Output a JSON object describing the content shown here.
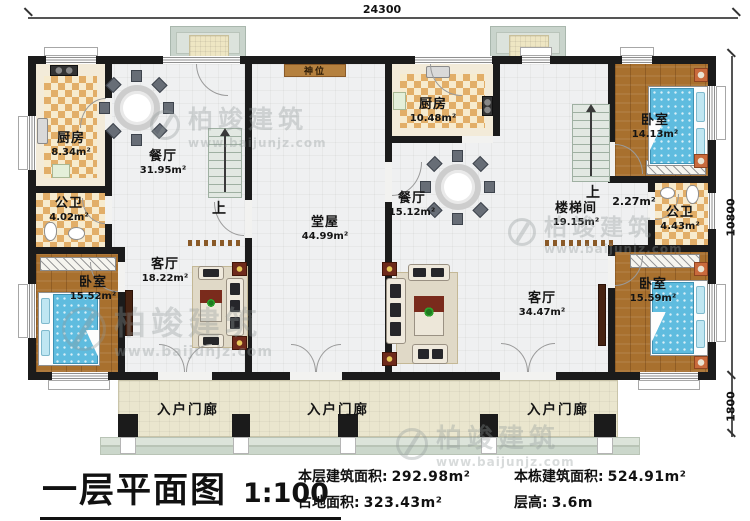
{
  "plan": {
    "dim_top": "24300",
    "dim_right": "10800",
    "dim_porch": "1800",
    "up_label": "上",
    "shrine_label": "神位",
    "porch_label": "入户门廊",
    "rooms": {
      "kitchen_left": {
        "name": "厨房",
        "area": "8.34m²"
      },
      "bath_left": {
        "name": "公卫",
        "area": "4.02m²"
      },
      "bedroom_left": {
        "name": "卧室",
        "area": "15.52m²"
      },
      "dining_left": {
        "name": "餐厅",
        "area": "31.95m²"
      },
      "living_left": {
        "name": "客厅",
        "area": "18.22m²"
      },
      "hall": {
        "name": "堂屋",
        "area": "44.99m²"
      },
      "kitchen_right": {
        "name": "厨房",
        "area": "10.48m²"
      },
      "dining_right": {
        "name": "餐厅",
        "area": "15.12m²"
      },
      "stairwell": {
        "name": "楼梯间",
        "area": "19.15m²"
      },
      "corridor": {
        "area": "2.27m²"
      },
      "bedroom_top_right": {
        "name": "卧室",
        "area": "14.13m²"
      },
      "bath_right": {
        "name": "公卫",
        "area": "4.43m²"
      },
      "bedroom_bottom_right": {
        "name": "卧室",
        "area": "15.59m²"
      },
      "living_right": {
        "name": "客厅",
        "area": "34.47m²"
      }
    }
  },
  "footer": {
    "title": "一层平面图",
    "scale": "1:100",
    "stats": [
      {
        "label": "本层建筑面积:",
        "value": "292.98m²"
      },
      {
        "label": "本栋建筑面积:",
        "value": "524.91m²"
      },
      {
        "label": "占地面积:",
        "value": "323.43m²"
      },
      {
        "label": "层高:",
        "value": "3.6m"
      }
    ]
  },
  "watermark": {
    "brand": "柏竣建筑",
    "url": "www.baijunjz.com"
  },
  "colors": {
    "wall": "#1b1b1b",
    "wood_floor": "#A8702E",
    "checker_tile": "#E2AE68",
    "bed_blue": "#5FBCDF",
    "porch_floor": "#EAE6CE",
    "shrine_wood": "#B5813F"
  }
}
